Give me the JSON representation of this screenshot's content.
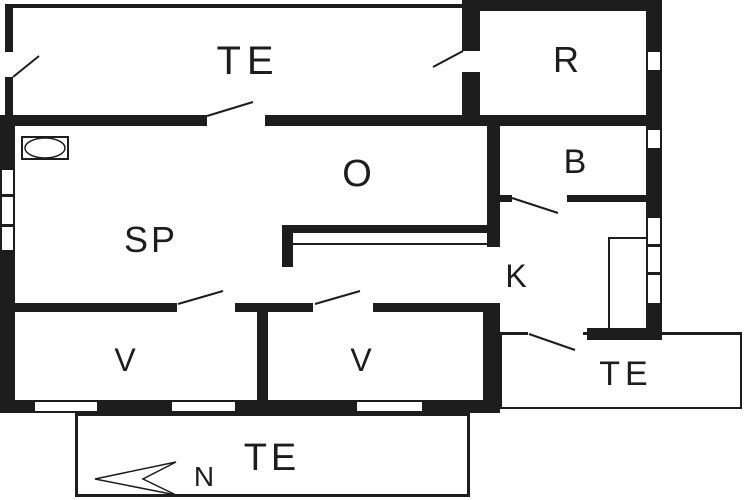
{
  "plan": {
    "type": "floor-plan",
    "rooms": [
      {
        "id": "terrace-top",
        "label": "TE"
      },
      {
        "id": "room-r",
        "label": "R"
      },
      {
        "id": "room-o",
        "label": "O"
      },
      {
        "id": "room-sp",
        "label": "SP"
      },
      {
        "id": "room-b",
        "label": "B"
      },
      {
        "id": "room-k",
        "label": "K"
      },
      {
        "id": "room-v1",
        "label": "V"
      },
      {
        "id": "room-v2",
        "label": "V"
      },
      {
        "id": "terrace-right",
        "label": "TE"
      },
      {
        "id": "terrace-bottom",
        "label": "TE"
      }
    ],
    "compass": {
      "label": "N"
    },
    "colors": {
      "ink": "#1d1d1d",
      "paper": "#ffffff"
    }
  }
}
